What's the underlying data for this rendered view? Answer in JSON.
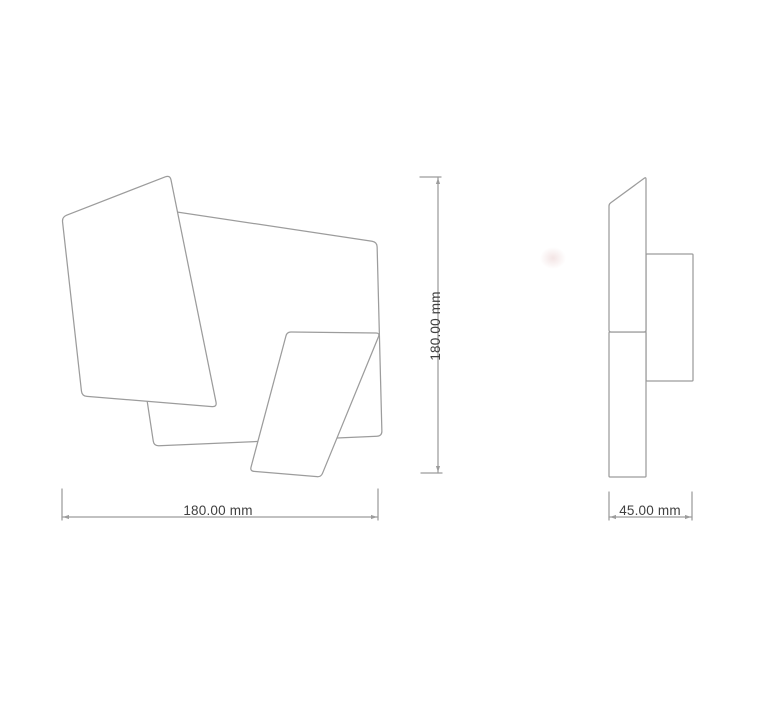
{
  "drawing": {
    "background": "#ffffff",
    "stroke_color": "#9c9c9c",
    "fill_color": "#ffffff",
    "label_color": "#3f3f3f",
    "stroke_width": 1.25,
    "views": {
      "front": {
        "id": "front-view"
      },
      "side": {
        "id": "side-view"
      }
    },
    "shapes": [
      {
        "id": "front-back-panel",
        "view": "front",
        "radius": 5,
        "points": [
          [
            117,
            203
          ],
          [
            377,
            242
          ],
          [
            382,
            436
          ],
          [
            154,
            446
          ]
        ]
      },
      {
        "id": "front-left-panel",
        "view": "front",
        "radius": 5,
        "points": [
          [
            62,
            217
          ],
          [
            170,
            175
          ],
          [
            217,
            407
          ],
          [
            82,
            396
          ]
        ]
      },
      {
        "id": "front-right-panel",
        "view": "front",
        "radius": 4,
        "points": [
          [
            287,
            332
          ],
          [
            380,
            333
          ],
          [
            321,
            477
          ],
          [
            250,
            471
          ]
        ]
      },
      {
        "id": "side-wall-mount",
        "view": "side",
        "radius": 1,
        "points": [
          [
            646,
            254
          ],
          [
            693,
            254
          ],
          [
            693,
            381
          ],
          [
            646,
            381
          ]
        ]
      },
      {
        "id": "side-lower-panel",
        "view": "side",
        "radius": 1,
        "points": [
          [
            609,
            332
          ],
          [
            646,
            332
          ],
          [
            646,
            477
          ],
          [
            609,
            477
          ]
        ]
      },
      {
        "id": "side-upper-panel",
        "view": "side",
        "radius": 2,
        "points": [
          [
            609,
            204
          ],
          [
            646,
            177
          ],
          [
            646,
            332
          ],
          [
            609,
            332
          ]
        ]
      }
    ],
    "dims": [
      {
        "id": "front-width",
        "label": "180.00 mm",
        "line": [
          [
            62,
            517
          ],
          [
            378,
            517
          ]
        ],
        "caps": [
          [
            [
              62,
              489
            ],
            [
              62,
              520
            ]
          ],
          [
            [
              378,
              489
            ],
            [
              378,
              520
            ]
          ]
        ],
        "arrows": [
          {
            "tip": [
              63,
              517
            ],
            "dir": "left"
          },
          {
            "tip": [
              377,
              517
            ],
            "dir": "right"
          }
        ],
        "label_pos": {
          "x": 218,
          "y": 515,
          "rotate": 0
        }
      },
      {
        "id": "front-height",
        "label": "180.00 mm",
        "line": [
          [
            438,
            177
          ],
          [
            438,
            473
          ]
        ],
        "caps": [
          [
            [
              420,
              177
            ],
            [
              441,
              177
            ]
          ],
          [
            [
              421,
              473
            ],
            [
              442,
              473
            ]
          ]
        ],
        "arrows": [
          {
            "tip": [
              438,
              178
            ],
            "dir": "up"
          },
          {
            "tip": [
              438,
              472
            ],
            "dir": "down"
          }
        ],
        "label_pos": {
          "x": 440,
          "y": 326,
          "rotate": -90
        }
      },
      {
        "id": "side-depth",
        "label": "45.00 mm",
        "line": [
          [
            609,
            517
          ],
          [
            692,
            517
          ]
        ],
        "caps": [
          [
            [
              609,
              492
            ],
            [
              609,
              520
            ]
          ],
          [
            [
              692,
              492
            ],
            [
              692,
              520
            ]
          ]
        ],
        "arrows": [
          {
            "tip": [
              610,
              517
            ],
            "dir": "left"
          },
          {
            "tip": [
              691,
              517
            ],
            "dir": "right"
          }
        ],
        "label_pos": {
          "x": 650,
          "y": 515,
          "rotate": 0
        }
      }
    ]
  }
}
